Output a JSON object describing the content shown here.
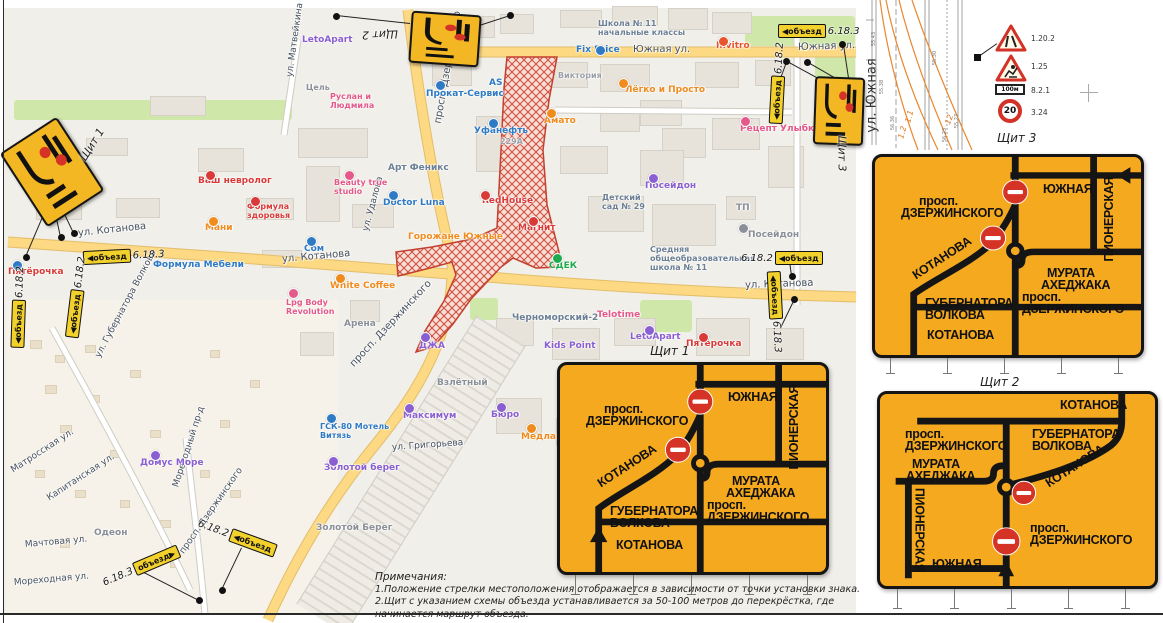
{
  "map": {
    "street_labels": [
      {
        "t": "Южная ул.",
        "x": 633,
        "y": 44,
        "r": 0,
        "s": 10
      },
      {
        "t": "Южная ул.",
        "x": 798,
        "y": 42,
        "r": -2,
        "s": 10
      },
      {
        "t": "ул. Котанова",
        "x": 78,
        "y": 228,
        "r": -6,
        "s": 10
      },
      {
        "t": "ул. Котанова",
        "x": 282,
        "y": 254,
        "r": -5,
        "s": 10
      },
      {
        "t": "ул. Котанова",
        "x": 745,
        "y": 280,
        "r": -2,
        "s": 10
      },
      {
        "t": "просп. Дзержинского",
        "x": 438,
        "y": 118,
        "r": -80,
        "s": 10
      },
      {
        "t": "просп. Дзержинского",
        "x": 352,
        "y": 360,
        "r": -47,
        "s": 10
      },
      {
        "t": "просп. Дзержинского",
        "x": 182,
        "y": 548,
        "r": -55,
        "s": 9
      },
      {
        "t": "ул. Матвейкина",
        "x": 290,
        "y": 72,
        "r": -82,
        "s": 9
      },
      {
        "t": "ул. Удалова",
        "x": 366,
        "y": 226,
        "r": -75,
        "s": 9
      },
      {
        "t": "ул. Губернатора Волкова",
        "x": 98,
        "y": 352,
        "r": -62,
        "s": 9
      },
      {
        "t": "Мореходный пр-д",
        "x": 176,
        "y": 482,
        "r": -72,
        "s": 9
      },
      {
        "t": "Матросская ул.",
        "x": 12,
        "y": 466,
        "r": -33,
        "s": 9
      },
      {
        "t": "Капитанская ул.",
        "x": 48,
        "y": 494,
        "r": -33,
        "s": 9
      },
      {
        "t": "Мачтовая ул.",
        "x": 25,
        "y": 540,
        "r": -5,
        "s": 9
      },
      {
        "t": "Мореходная ул.",
        "x": 14,
        "y": 578,
        "r": -5,
        "s": 9
      },
      {
        "t": "ул. Григорьева",
        "x": 392,
        "y": 443,
        "r": -4,
        "s": 9
      }
    ],
    "poi_labels": [
      {
        "t": "Fix Price",
        "x": 576,
        "y": 46,
        "c": "#2f7ac5"
      },
      {
        "t": "Школа № 11\nначальные классы",
        "x": 598,
        "y": 20,
        "c": "#6b7f95",
        "s": 8
      },
      {
        "t": "Invitro",
        "x": 716,
        "y": 42,
        "c": "#e8542e"
      },
      {
        "t": "Лёгко и Просто",
        "x": 625,
        "y": 86,
        "c": "#f08c1e"
      },
      {
        "t": "Рецепт Улыбки",
        "x": 740,
        "y": 125,
        "c": "#e5588a"
      },
      {
        "t": "Посейдон",
        "x": 645,
        "y": 182,
        "c": "#8a5fd1"
      },
      {
        "t": "Посейдон",
        "x": 748,
        "y": 231,
        "c": "#8a8f98"
      },
      {
        "t": "ТП",
        "x": 736,
        "y": 204,
        "c": "#8a8f98"
      },
      {
        "t": "Детский\nсад № 29",
        "x": 602,
        "y": 194,
        "c": "#6b7f95",
        "s": 8
      },
      {
        "t": "Магнит",
        "x": 518,
        "y": 224,
        "c": "#d93a38"
      },
      {
        "t": "СДЕК",
        "x": 549,
        "y": 262,
        "c": "#1faa4e"
      },
      {
        "t": "Средняя\nобщеобразовательная\nшкола № 11",
        "x": 650,
        "y": 246,
        "c": "#6b7f95",
        "s": 8
      },
      {
        "t": "Черноморский-2",
        "x": 512,
        "y": 314,
        "c": "#6b7f95"
      },
      {
        "t": "Kids Point",
        "x": 544,
        "y": 342,
        "c": "#8a5fd1"
      },
      {
        "t": "Telotime",
        "x": 597,
        "y": 311,
        "c": "#e5588a"
      },
      {
        "t": "LetoApart",
        "x": 630,
        "y": 333,
        "c": "#8a5fd1"
      },
      {
        "t": "Пятёрочка",
        "x": 686,
        "y": 340,
        "c": "#d93a38"
      },
      {
        "t": "Пятёрочка",
        "x": 8,
        "y": 268,
        "c": "#d93a38"
      },
      {
        "t": "LetoApart",
        "x": 302,
        "y": 36,
        "c": "#8a5fd1"
      },
      {
        "t": "Цель",
        "x": 306,
        "y": 84,
        "c": "#8a8f98",
        "s": 8
      },
      {
        "t": "Руслан и\nЛюдмила",
        "x": 330,
        "y": 93,
        "c": "#e5588a",
        "s": 8
      },
      {
        "t": "Beauty true\nstudio",
        "x": 334,
        "y": 179,
        "c": "#e5588a",
        "s": 8
      },
      {
        "t": "Ваш невролог",
        "x": 198,
        "y": 177,
        "c": "#d93a38"
      },
      {
        "t": "Формула\nздоровья",
        "x": 247,
        "y": 203,
        "c": "#d93a38",
        "s": 8
      },
      {
        "t": "Мани",
        "x": 205,
        "y": 224,
        "c": "#f08c1e"
      },
      {
        "t": "Сом",
        "x": 304,
        "y": 245,
        "c": "#2f7ac5"
      },
      {
        "t": "Формула Мебели",
        "x": 153,
        "y": 261,
        "c": "#2f7ac5"
      },
      {
        "t": "White Coffee",
        "x": 330,
        "y": 282,
        "c": "#f08c1e"
      },
      {
        "t": "Горожане Южные",
        "x": 408,
        "y": 233,
        "c": "#f08c1e"
      },
      {
        "t": "Doctor Luna",
        "x": 383,
        "y": 199,
        "c": "#2f7ac5"
      },
      {
        "t": "RedHouse",
        "x": 482,
        "y": 197,
        "c": "#d93a38"
      },
      {
        "t": "Арт Феникс",
        "x": 388,
        "y": 164,
        "c": "#6b7f95"
      },
      {
        "t": "Уфанефть",
        "x": 474,
        "y": 127,
        "c": "#2f7ac5"
      },
      {
        "t": "229А",
        "x": 500,
        "y": 138,
        "c": "#9aa0a8",
        "s": 8
      },
      {
        "t": "Прокат-Сервис",
        "x": 426,
        "y": 90,
        "c": "#2f7ac5"
      },
      {
        "t": "AS",
        "x": 489,
        "y": 79,
        "c": "#2f7ac5"
      },
      {
        "t": "Амато",
        "x": 544,
        "y": 117,
        "c": "#f08c1e"
      },
      {
        "t": "Виктория",
        "x": 558,
        "y": 72,
        "c": "#9aa0a8",
        "s": 8
      },
      {
        "t": "ДЖА",
        "x": 419,
        "y": 342,
        "c": "#8a5fd1"
      },
      {
        "t": "Арена",
        "x": 344,
        "y": 320,
        "c": "#8a8f98"
      },
      {
        "t": "Взлётный",
        "x": 437,
        "y": 379,
        "c": "#8a8f98"
      },
      {
        "t": "Максимум",
        "x": 403,
        "y": 412,
        "c": "#8a5fd1"
      },
      {
        "t": "Бюро",
        "x": 491,
        "y": 411,
        "c": "#8a5fd1"
      },
      {
        "t": "Медлайна",
        "x": 521,
        "y": 433,
        "c": "#f08c1e"
      },
      {
        "t": "ГСК-80 Мотель\nВитязь",
        "x": 320,
        "y": 423,
        "c": "#2f7ac5",
        "s": 8
      },
      {
        "t": "Золотой берег",
        "x": 324,
        "y": 464,
        "c": "#8a5fd1"
      },
      {
        "t": "Золотой Берег",
        "x": 316,
        "y": 524,
        "c": "#8a8f98"
      },
      {
        "t": "Lpg Body\nRevolution",
        "x": 286,
        "y": 299,
        "c": "#e5588a",
        "s": 8
      },
      {
        "t": "Домус Море",
        "x": 140,
        "y": 459,
        "c": "#8a5fd1"
      },
      {
        "t": "Одеон",
        "x": 94,
        "y": 529,
        "c": "#8a8f98"
      }
    ],
    "shield_markers": [
      {
        "x": 18,
        "y": 128,
        "w": 64,
        "h": 84,
        "r": -33
      },
      {
        "x": 410,
        "y": 13,
        "w": 66,
        "h": 48,
        "r": 4
      },
      {
        "x": 814,
        "y": 77,
        "w": 46,
        "h": 64,
        "r": 2
      }
    ],
    "shield_marker_labels": [
      {
        "t": "Щит 1",
        "x": 74,
        "y": 138,
        "r": -58
      },
      {
        "t": "Щит 2",
        "x": 362,
        "y": 28,
        "r": 178
      },
      {
        "t": "Щит 3",
        "x": 824,
        "y": 147,
        "r": 90
      }
    ],
    "detour_signs": [
      {
        "x": 83,
        "y": 249,
        "r": -3,
        "plate": "◀объезд",
        "code": "6.18.3"
      },
      {
        "x": 36,
        "y": 290,
        "r": -83,
        "plate": "◀объезд",
        "code": "6.18.2"
      },
      {
        "x": -22,
        "y": 300,
        "r": -88,
        "plate": "◀объезд",
        "code": "6.18.2"
      },
      {
        "x": 778,
        "y": 24,
        "r": 0,
        "plate": "◀объезд",
        "code": "6.18.3"
      },
      {
        "x": 737,
        "y": 76,
        "r": -87,
        "plate": "◀объезд",
        "code": "6.18.2"
      },
      {
        "x": 741,
        "y": 251,
        "r": 0,
        "plate": "◀объезд",
        "code": "6.18.2",
        "code_first": true
      },
      {
        "x": 735,
        "y": 305,
        "r": 87,
        "plate": "◀объезд",
        "code": "6.18.3"
      },
      {
        "x": 100,
        "y": 560,
        "r": -23,
        "plate": "объезд▶",
        "code": "6.18.3",
        "code_first": true
      },
      {
        "x": 196,
        "y": 530,
        "r": 20,
        "plate": "◀объезд",
        "code": "6.18.2",
        "code_first": true
      }
    ],
    "dots": [
      {
        "x": 26,
        "y": 257
      },
      {
        "x": 61,
        "y": 237
      },
      {
        "x": 74,
        "y": 233
      },
      {
        "x": 336,
        "y": 16
      },
      {
        "x": 510,
        "y": 15
      },
      {
        "x": 786,
        "y": 61
      },
      {
        "x": 807,
        "y": 62
      },
      {
        "x": 842,
        "y": 44
      },
      {
        "x": 792,
        "y": 276
      },
      {
        "x": 794,
        "y": 299
      },
      {
        "x": 199,
        "y": 600
      },
      {
        "x": 222,
        "y": 590
      }
    ],
    "leaders": [
      {
        "x1": 52,
        "y1": 196,
        "x2": 26,
        "y2": 257
      },
      {
        "x1": 52,
        "y1": 196,
        "x2": 61,
        "y2": 237
      },
      {
        "x1": 55,
        "y1": 193,
        "x2": 74,
        "y2": 233
      },
      {
        "x1": 410,
        "y1": 24,
        "x2": 336,
        "y2": 16
      },
      {
        "x1": 476,
        "y1": 26,
        "x2": 510,
        "y2": 15
      },
      {
        "x1": 820,
        "y1": 80,
        "x2": 787,
        "y2": 62
      },
      {
        "x1": 834,
        "y1": 78,
        "x2": 808,
        "y2": 63
      },
      {
        "x1": 848,
        "y1": 78,
        "x2": 843,
        "y2": 45
      },
      {
        "x1": 772,
        "y1": 100,
        "x2": 786,
        "y2": 62
      },
      {
        "x1": 790,
        "y1": 261,
        "x2": 792,
        "y2": 276
      },
      {
        "x1": 780,
        "y1": 328,
        "x2": 794,
        "y2": 299
      },
      {
        "x1": 140,
        "y1": 570,
        "x2": 199,
        "y2": 600
      },
      {
        "x1": 242,
        "y1": 548,
        "x2": 222,
        "y2": 590
      },
      {
        "x1": 977,
        "y1": 57,
        "x2": 997,
        "y2": 43
      }
    ]
  },
  "shields": {
    "names": {
      "yuzhnaya": "ЮЖНАЯ",
      "pionerskaya": "ПИОНЕРСКАЯ",
      "prosp": "просп.",
      "dzerzhinskogo": "ДЗЕРЖИНСКОГО",
      "kotanova": "КОТАНОВА",
      "murata1": "МУРАТА",
      "murata2": "АХЕДЖАКА",
      "gubernatora1": "ГУБЕРНАТОРА",
      "gubernatora2": "ВОЛКОВА"
    },
    "sh1": {
      "caption": "Щит 1"
    },
    "sh2": {
      "caption": "Щит 2"
    },
    "sh3": {
      "caption": "Щит 3"
    }
  },
  "cad": {
    "street": "ул. Южная",
    "signs": [
      {
        "code": "1.20.2"
      },
      {
        "code": "1.25"
      },
      {
        "code": "8.2.1",
        "value": "100м"
      },
      {
        "code": "3.24",
        "value": "20"
      }
    ],
    "orange_nums": [
      {
        "t": "1.1",
        "x": 903,
        "y": 112,
        "r": -75
      },
      {
        "t": "1.2",
        "x": 896,
        "y": 128,
        "r": -75
      },
      {
        "t": "12",
        "x": 944,
        "y": 115,
        "r": -70
      }
    ],
    "elevations": [
      {
        "t": "55.43",
        "x": 867,
        "y": 36
      },
      {
        "t": "55.38",
        "x": 875,
        "y": 84
      },
      {
        "t": "56.36",
        "x": 886,
        "y": 120
      },
      {
        "t": "55.30",
        "x": 928,
        "y": 55
      },
      {
        "t": "55.27",
        "x": 950,
        "y": 118
      },
      {
        "t": "56.23",
        "x": 938,
        "y": 132
      }
    ]
  },
  "notes": {
    "title": "Примечания:",
    "items": [
      "1.Положение стрелки местоположения отображается в зависимости от точки установки знака.",
      "2.Щит с указанием схемы объезда устанавливается за 50-100 метров до перекрёстка, где начинается маршрут объезда."
    ]
  }
}
